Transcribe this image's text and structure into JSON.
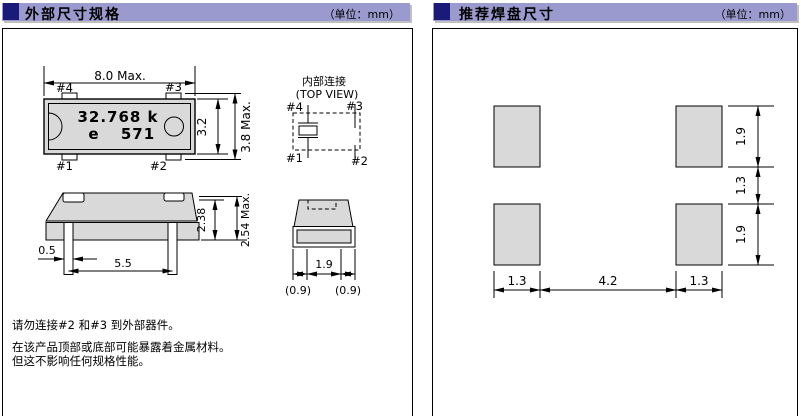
{
  "colors": {
    "header_bar": "#9a9ace",
    "header_square": "#1a1a78",
    "part_fill": "#d9d9d9",
    "line": "#000000"
  },
  "left_panel": {
    "title": "外部尺寸规格",
    "unit": "（单位：mm）",
    "top_view": {
      "width_dim": "8.0 Max.",
      "pin4": "#4",
      "pin3": "#3",
      "pin1": "#1",
      "pin2": "#2",
      "marking_line1": "32.768 k",
      "marking_e": "e",
      "marking_num": "571",
      "body_height_dim": "3.2",
      "total_height_dim": "3.8 Max."
    },
    "internal_connection": {
      "title": "内部连接",
      "subtitle": "(TOP VIEW)",
      "pin4": "#4",
      "pin3": "#3",
      "pin1": "#1",
      "pin2": "#2"
    },
    "side_view": {
      "body_height_dim": "2.38",
      "total_height_dim": "2.54 Max.",
      "lead_width_dim": "0.5",
      "lead_pitch_dim": "5.5"
    },
    "end_view": {
      "lead_span_dim": "1.9",
      "left_margin_dim": "(0.9)",
      "right_margin_dim": "(0.9)"
    },
    "notes": [
      "请勿连接#2 和#3 到外部器件。",
      "在该产品顶部或底部可能暴露着金属材料。",
      "但这不影响任何规格性能。"
    ]
  },
  "right_panel": {
    "title": "推荐焊盘尺寸",
    "unit": "（单位：mm）",
    "pad_height_top_dim": "1.9",
    "pad_gap_dim": "1.3",
    "pad_height_bottom_dim": "1.9",
    "pad_width_left_dim": "1.3",
    "pad_pitch_dim": "4.2",
    "pad_width_right_dim": "1.3"
  }
}
